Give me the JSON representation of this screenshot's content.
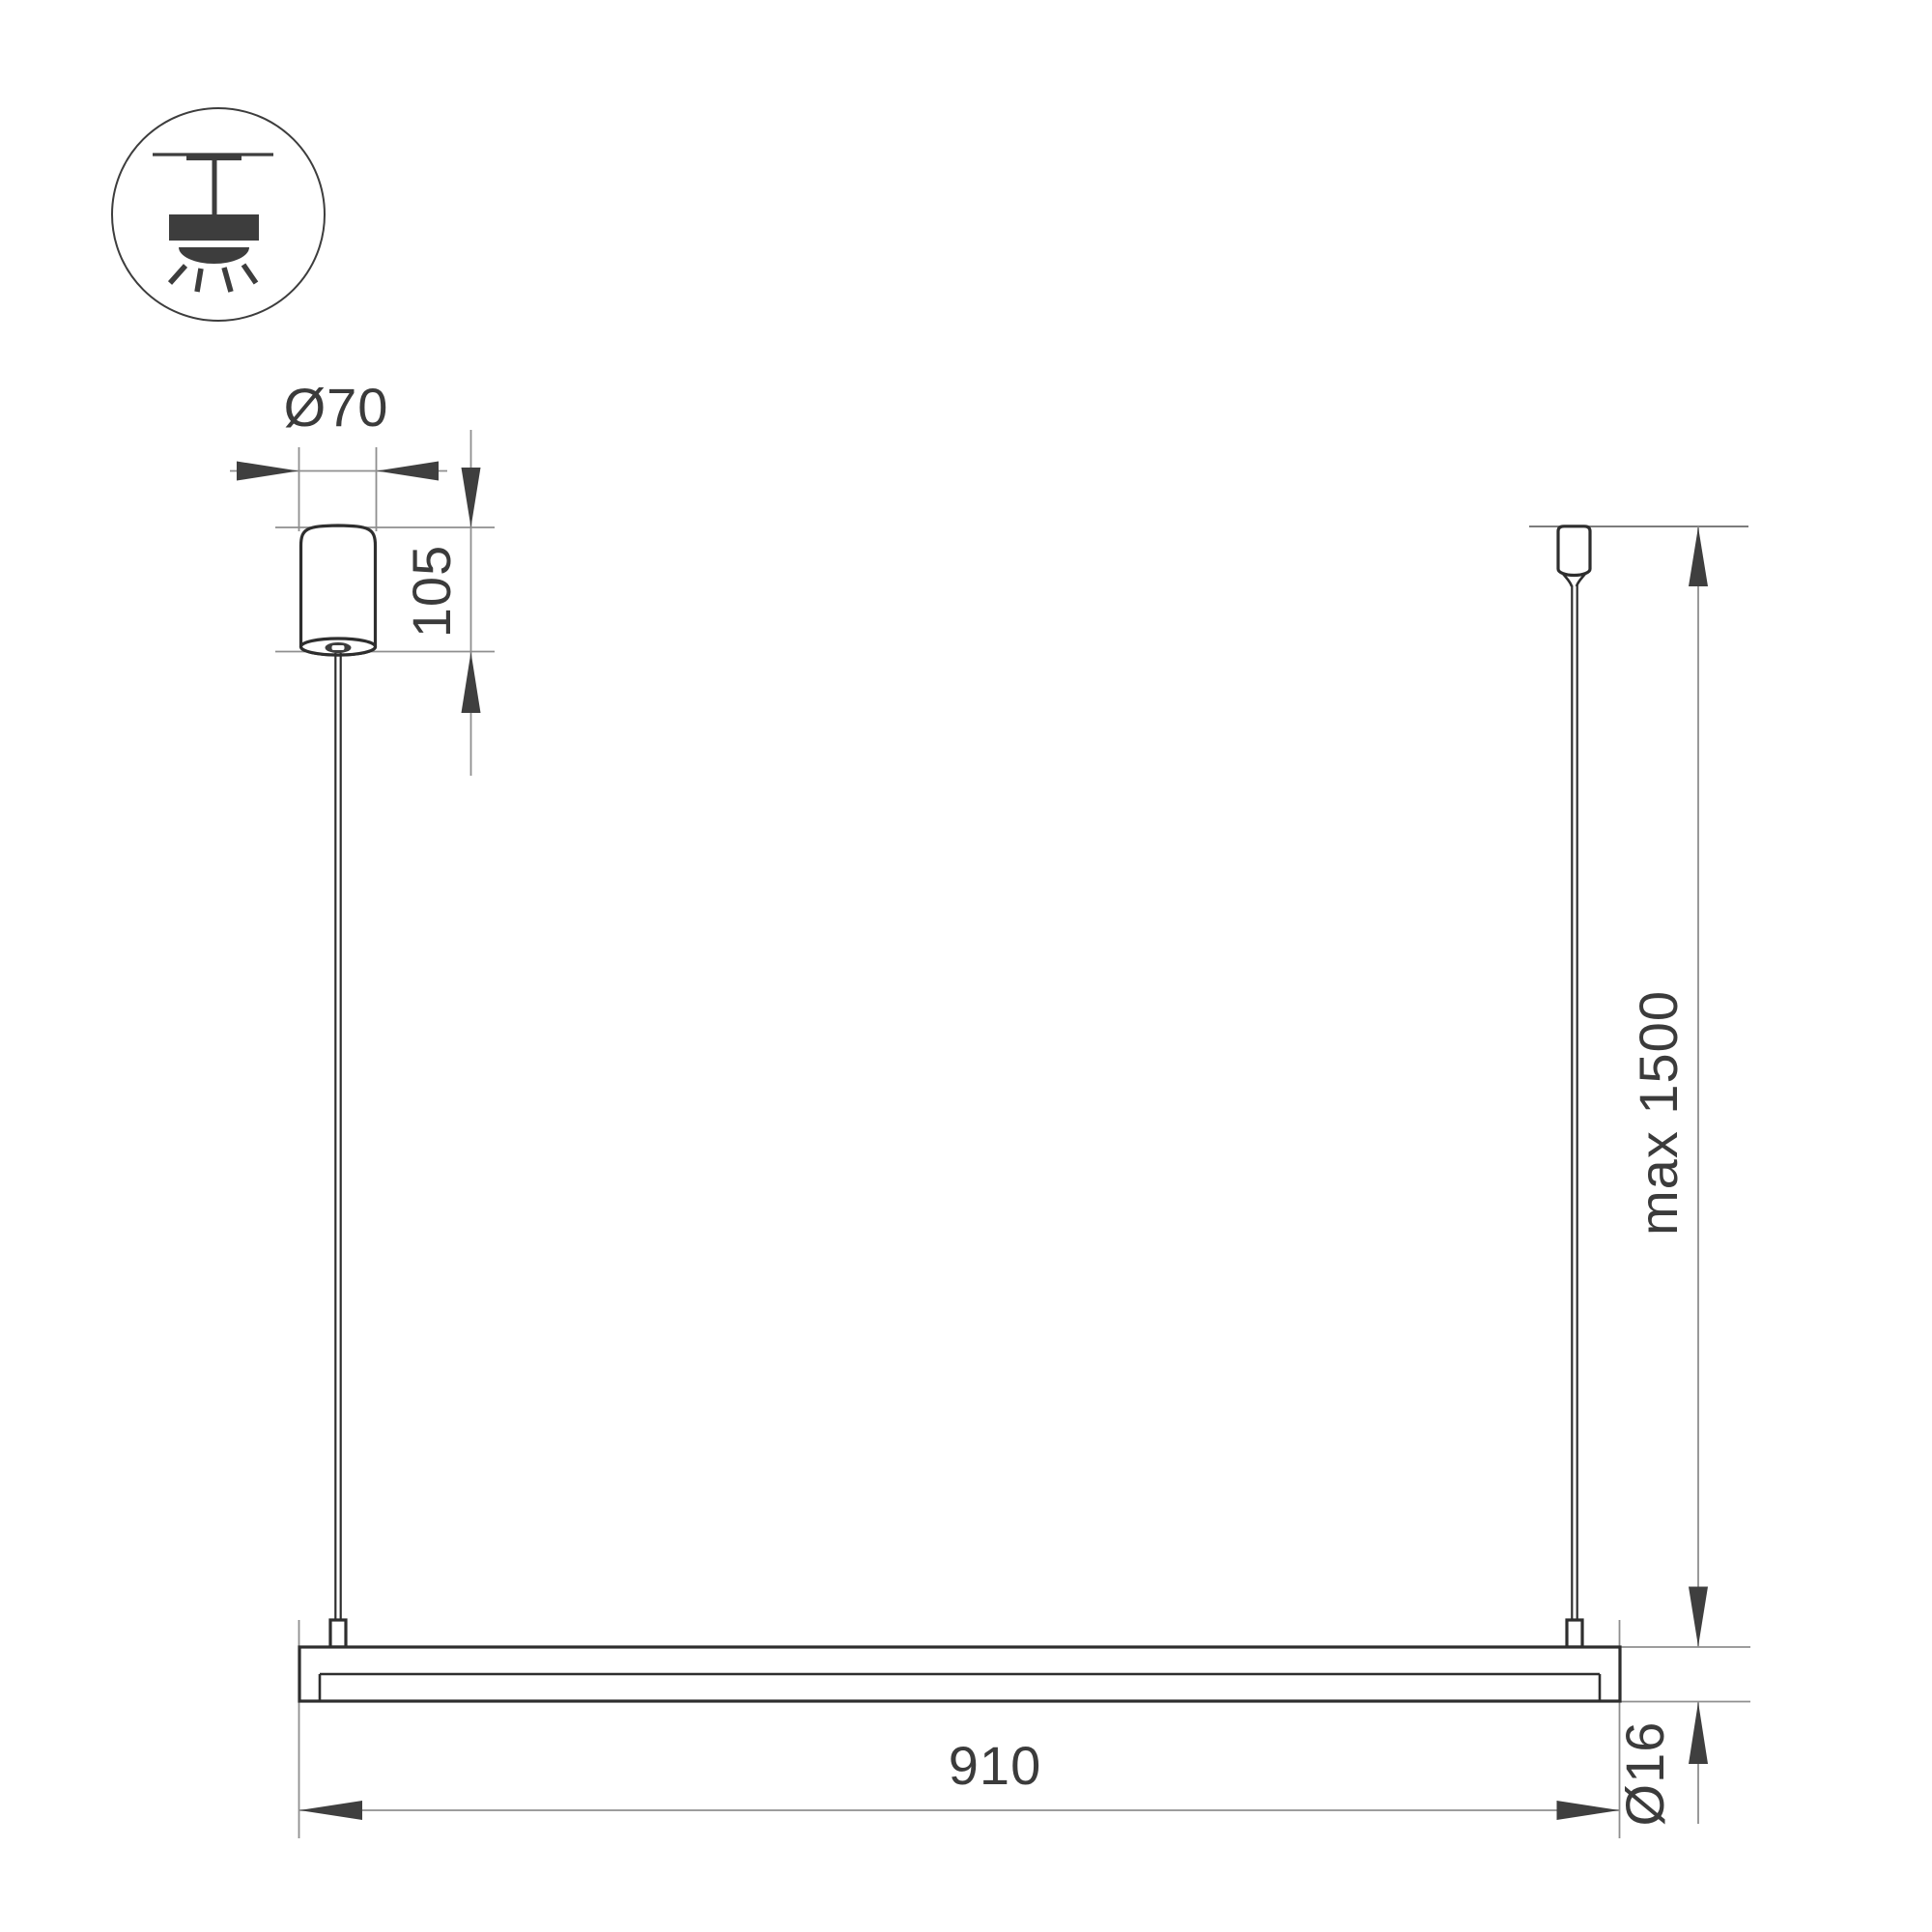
{
  "labels": {
    "canopy_diameter": "Ø70",
    "canopy_height": "105",
    "suspension_max": "max 1500",
    "fixture_length": "910",
    "tube_diameter": "Ø16"
  },
  "icons": {
    "mount_type": "pendant-ceiling-light-icon"
  },
  "palette": {
    "background": "#ffffff",
    "object_outline": "#2e2e2e",
    "dimension_line": "#8f8f8f",
    "arrow": "#3f3f3f",
    "text": "#3b3b3b",
    "icon": "#3d3d3d"
  }
}
